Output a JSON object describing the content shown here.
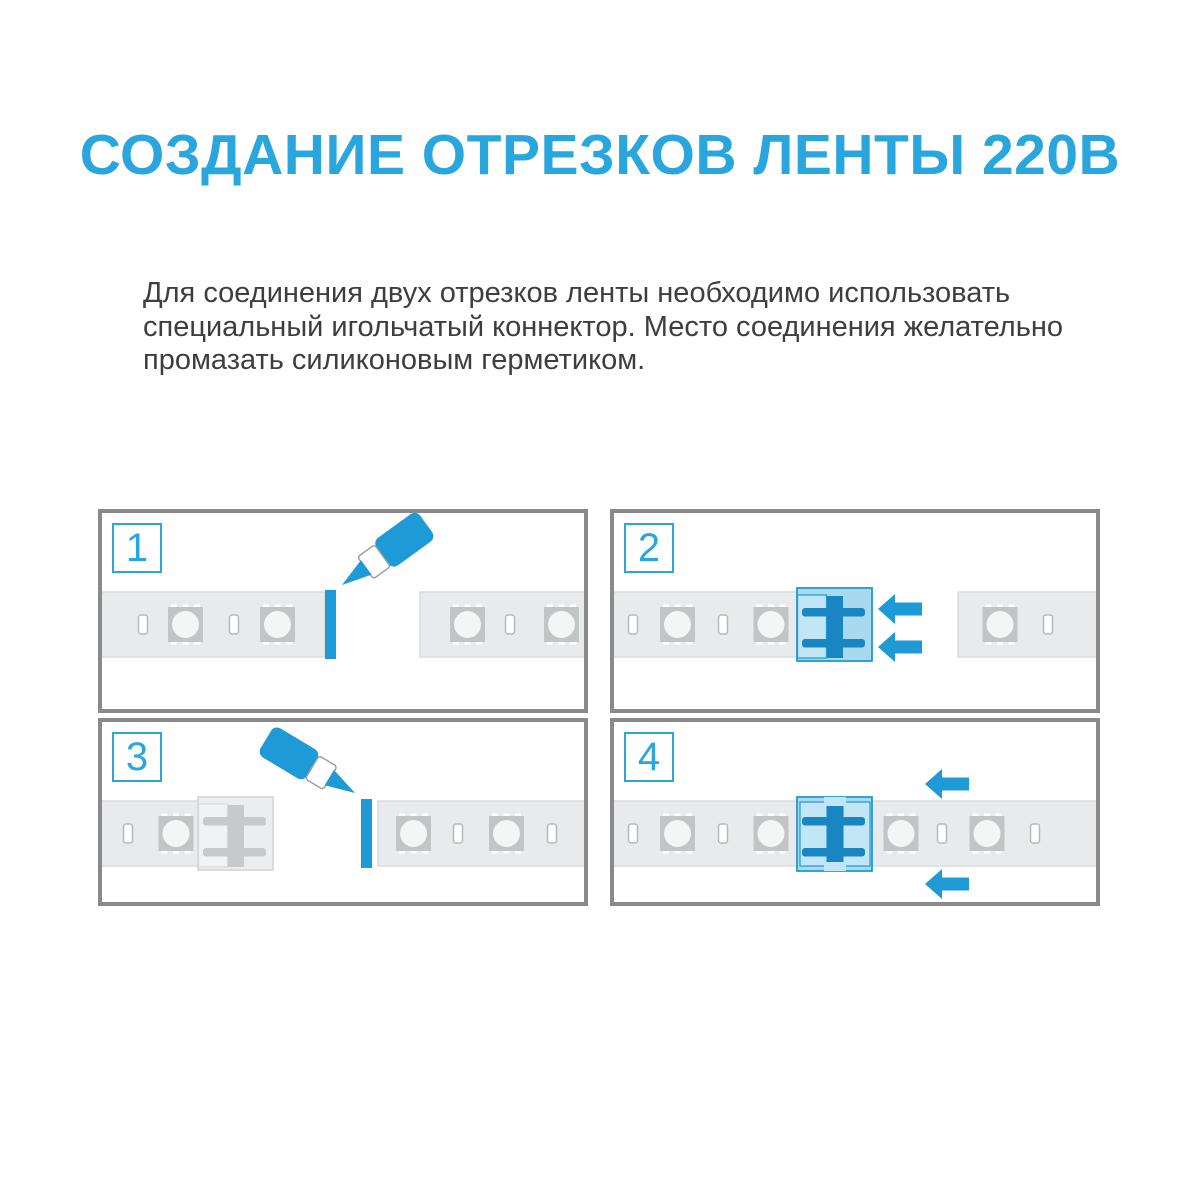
{
  "page": {
    "title": "СОЗДАНИЕ ОТРЕЗКОВ ЛЕНТЫ 220В",
    "description_lines": [
      "Для соединения двух отрезков ленты необходимо использовать",
      "специальный игольчатый коннектор. Место соединения желательно",
      "промазать силиконовым герметиком."
    ]
  },
  "steps": [
    {
      "number": "1",
      "alt": "нанесение силиконового герметика на срез ленты"
    },
    {
      "number": "2",
      "alt": "игольчатый коннектор надевается на конец ленты"
    },
    {
      "number": "3",
      "alt": "нанесение герметика на срез второй ленты"
    },
    {
      "number": "4",
      "alt": "две ленты соединены коннектором"
    }
  ],
  "colors": {
    "accent_blue": "#1E9AD6",
    "title_blue": "#2AA6DE",
    "connector_dark_blue": "#1985C1",
    "connector_light_blue": "#A9D9EF",
    "connector_lighter_blue": "#C2E6F5",
    "strip_gray": "#E9EAEB",
    "strip_border_gray": "#DBDCDD",
    "led_gray": "#C2C5C6",
    "panel_border_gray": "#8A8A8A",
    "text_dark": "#3E3E3E"
  }
}
